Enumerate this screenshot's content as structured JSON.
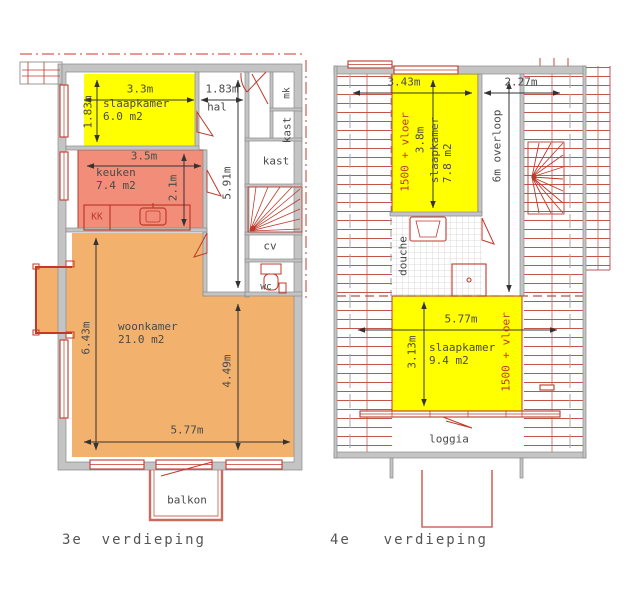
{
  "left_plan": {
    "caption": "3e verdieping",
    "rooms": {
      "slaapkamer_name": "slaapkamer",
      "slaapkamer_area": "6.0 m2",
      "hal": "hal",
      "mk": "mk",
      "kast_vertical": "kast",
      "kast": "kast",
      "keuken_name": "keuken",
      "keuken_area": "7.4 m2",
      "kk": "KK",
      "cv": "cv",
      "wc": "wc",
      "woonkamer_name": "woonkamer",
      "woonkamer_area": "21.0 m2",
      "balkon": "balkon"
    },
    "dims": {
      "slaapkamer_width": "3.3m",
      "hal_width": "1.83m",
      "slaapkamer_depth": "1.83m",
      "keuken_width": "3.5m",
      "keuken_depth": "2.1m",
      "hal_depth": "5.91m",
      "woonkamer_depth_left": "6.43m",
      "woonkamer_depth_right": "4.49m",
      "woonkamer_width": "5.77m"
    }
  },
  "right_plan": {
    "caption": "4e verdieping",
    "rooms": {
      "slaapkamer1_name": "slaapkamer",
      "slaapkamer1_area": "7.8 m2",
      "overloop": "6m overloop",
      "douche": "douche",
      "slaapkamer2_name": "slaapkamer",
      "slaapkamer2_area": "9.4 m2",
      "loggia": "loggia"
    },
    "dims": {
      "left_width": "3.43m",
      "right_width": "2.27m",
      "slaapkamer1_depth": "3.8m",
      "slaapkamer2_width": "5.77m",
      "slaapkamer2_depth": "3.13m",
      "headroom_note_1": "1500 + vloer",
      "headroom_note_2": "1500 + vloer"
    }
  },
  "colors": {
    "room_yellow": "#ffff00",
    "kitchen_salmon": "#f28d79",
    "living_orange": "#f2b26e",
    "line_red": "#c0392b",
    "soft_red": "#cd6a5e",
    "wall_gray": "#c4c4c4",
    "text_gray": "#4a4a4a"
  }
}
